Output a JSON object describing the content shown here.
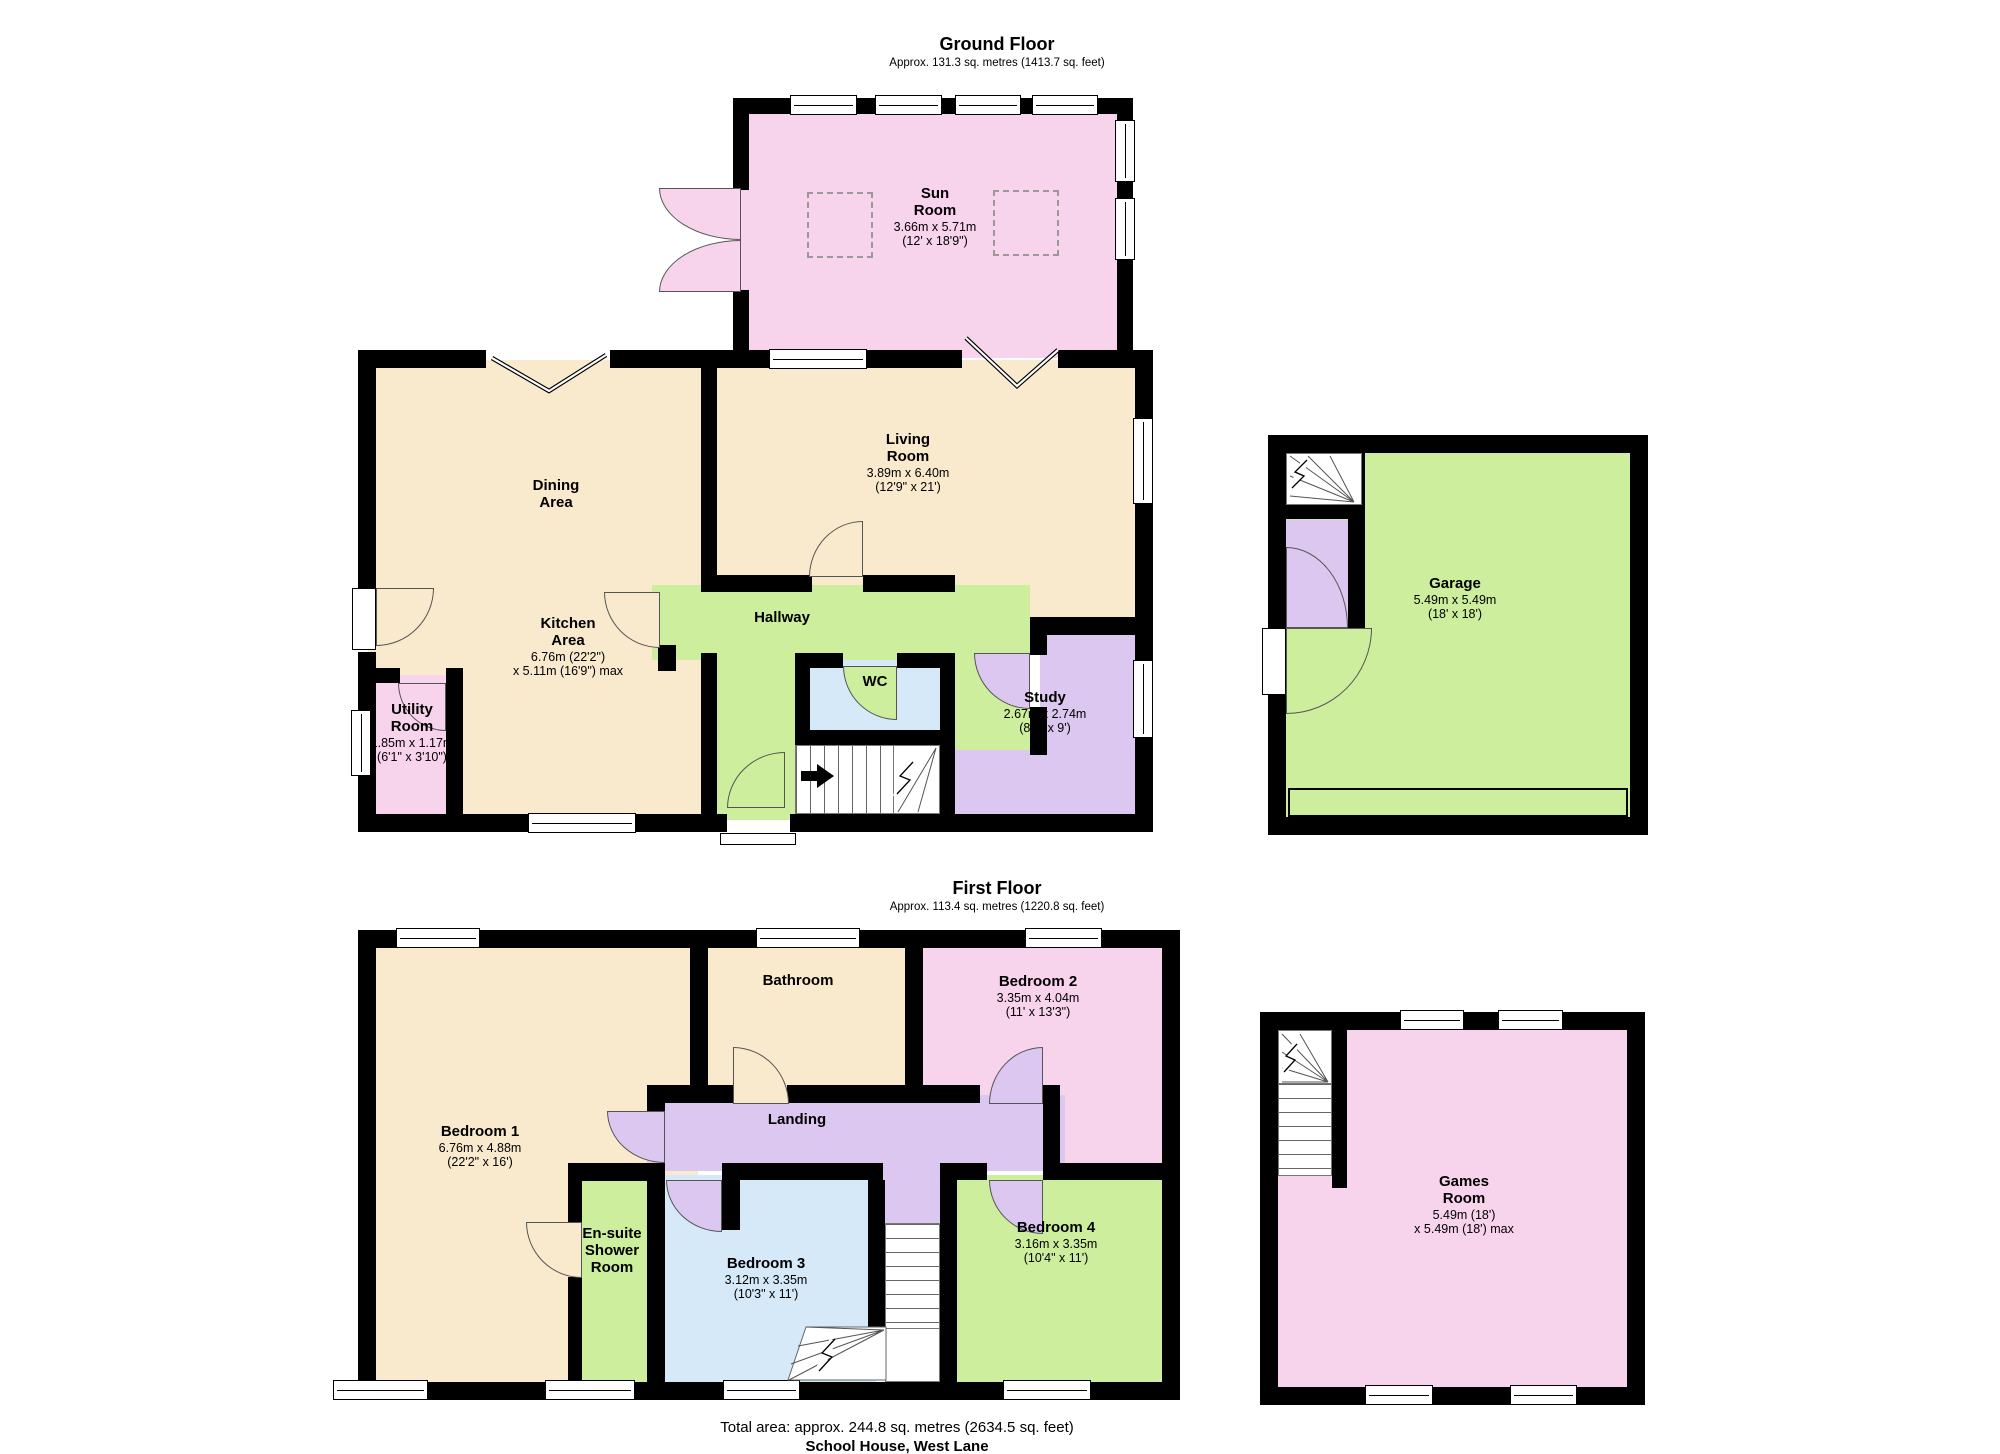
{
  "colors": {
    "cream": "#FAEACD",
    "pink": "#F8D4EC",
    "green": "#CDEE9C",
    "lav": "#DBC7F0",
    "blue": "#D5E9F8",
    "wall": "#000000",
    "text": "#000000"
  },
  "ground_floor": {
    "title": "Ground Floor",
    "subtitle": "Approx. 131.3 sq. metres (1413.7 sq. feet)",
    "rooms": {
      "sun_room": {
        "name": "Sun Room",
        "dim_m": "3.66m x 5.71m",
        "dim_ft": "(12' x 18'9\")"
      },
      "dining_area": {
        "name": "Dining Area"
      },
      "kitchen_area": {
        "name": "Kitchen Area",
        "dim_m": "6.76m (22'2\")",
        "dim_ft": "x 5.11m (16'9\") max"
      },
      "living_room": {
        "name": "Living Room",
        "dim_m": "3.89m x 6.40m",
        "dim_ft": "(12'9\" x 21')"
      },
      "hallway": {
        "name": "Hallway"
      },
      "wc": {
        "name": "WC"
      },
      "study": {
        "name": "Study",
        "dim_m": "2.67m x 2.74m",
        "dim_ft": "(8'9\" x 9')"
      },
      "utility_room": {
        "name": "Utility Room",
        "dim_m": "1.85m x 1.17m",
        "dim_ft": "(6'1\" x 3'10\")"
      },
      "garage": {
        "name": "Garage",
        "dim_m": "5.49m x 5.49m",
        "dim_ft": "(18' x 18')"
      }
    }
  },
  "first_floor": {
    "title": "First Floor",
    "subtitle": "Approx. 113.4 sq. metres (1220.8 sq. feet)",
    "rooms": {
      "bedroom_1": {
        "name": "Bedroom 1",
        "dim_m": "6.76m x 4.88m",
        "dim_ft": "(22'2\" x 16')"
      },
      "bathroom": {
        "name": "Bathroom"
      },
      "bedroom_2": {
        "name": "Bedroom 2",
        "dim_m": "3.35m x 4.04m",
        "dim_ft": "(11' x 13'3\")"
      },
      "landing": {
        "name": "Landing"
      },
      "ensuite": {
        "name": "En-suite Shower Room"
      },
      "bedroom_3": {
        "name": "Bedroom 3",
        "dim_m": "3.12m x 3.35m",
        "dim_ft": "(10'3\" x 11')"
      },
      "bedroom_4": {
        "name": "Bedroom 4",
        "dim_m": "3.16m x 3.35m",
        "dim_ft": "(10'4\" x 11')"
      },
      "games_room": {
        "name": "Games Room",
        "dim_m": "5.49m (18')",
        "dim_ft": "x 5.49m (18') max"
      }
    }
  },
  "footer": {
    "total_area": "Total area: approx. 244.8 sq. metres (2634.5 sq. feet)",
    "address": "School House, West Lane"
  }
}
